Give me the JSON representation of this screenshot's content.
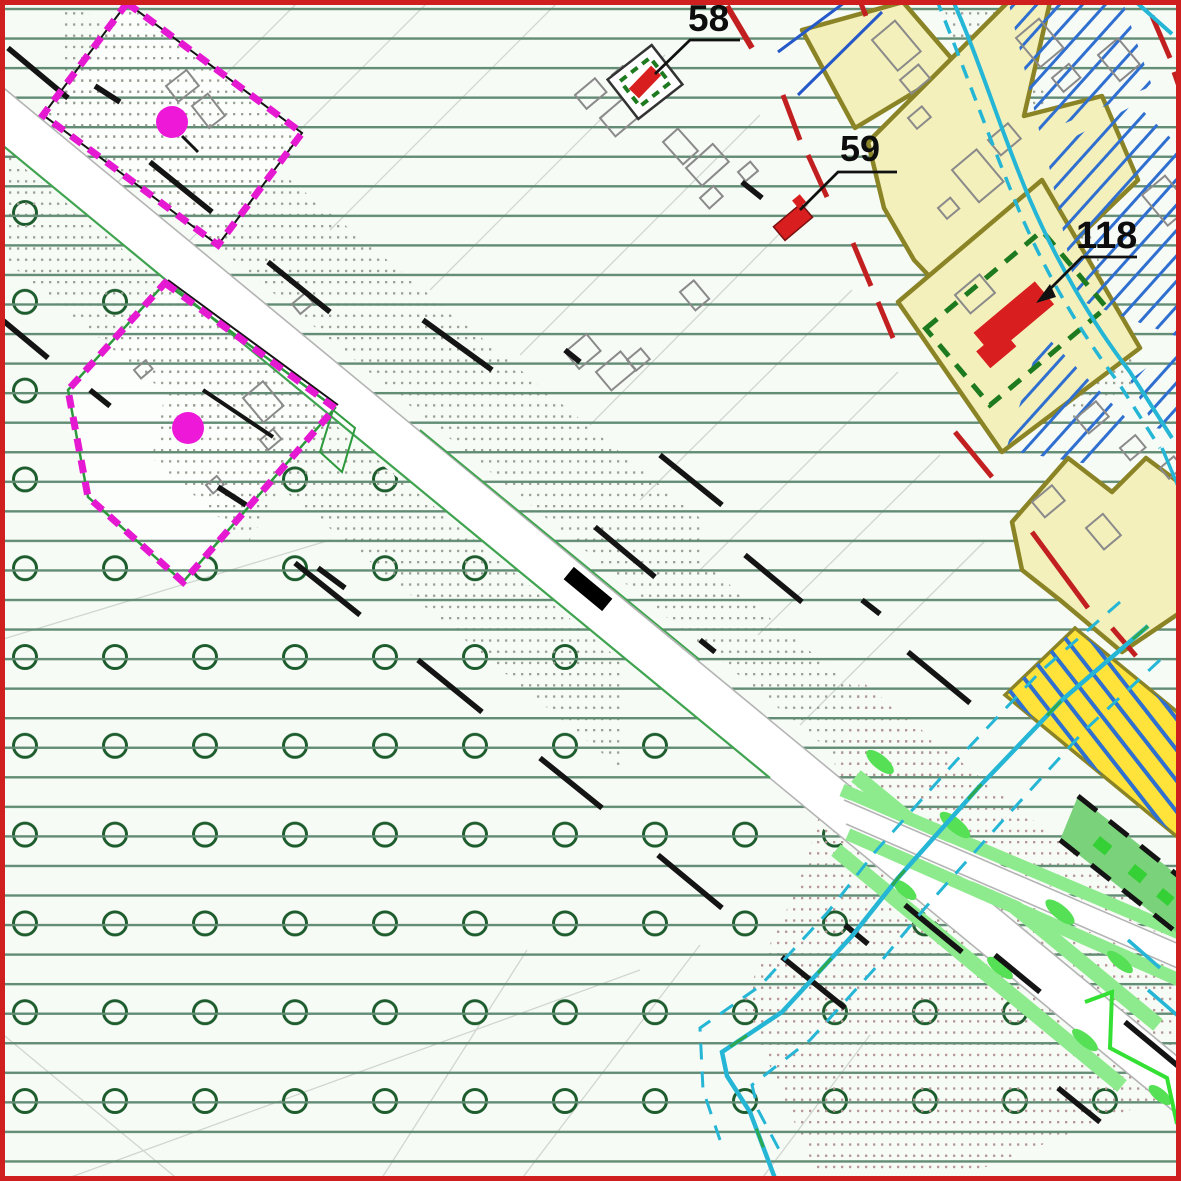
{
  "map": {
    "kind": "cadastral-zoning-plan",
    "labels": [
      {
        "id": "parcel-58",
        "text": "58"
      },
      {
        "id": "parcel-59",
        "text": "59"
      },
      {
        "id": "parcel-118",
        "text": "118"
      }
    ],
    "colors": {
      "frame_red": "#d01f1f",
      "background": "#f7fbf6",
      "grid_line_green": "#628c74",
      "orchard_circle_green": "#1d5c2d",
      "boundary_magenta": "#e619d2",
      "boundary_outline_black": "#141414",
      "boundary_outline_green": "#2c9a3c",
      "zone_fill_pale_yellow": "#f4f0bc",
      "zone_border_olive": "#8b8426",
      "bright_zone_yellow": "#ffe23a",
      "hatch_blue": "#2f6fd0",
      "water_cyan": "#25b6d6",
      "water_green": "#2ea84e",
      "building_red": "#d81e1e",
      "building_gray_outline": "#8a8a8a",
      "road_fill": "#ffffff",
      "road_edge_gray": "#b4b4b4",
      "road_edge_green": "#3fa34f",
      "verge_light_green": "#8deb8d",
      "verge_blob_green": "#55e055",
      "strip_green": "#7ad37a",
      "black_dash": "#141414",
      "red_boundary_dash": "#c22020",
      "stipple_gray": "#9aa094",
      "stipple_rose": "#b39595",
      "protected_green_dash": "#1e7a1e",
      "parcel_line_gray": "#d0d6d0",
      "magenta_dot": "#ee18d8"
    },
    "symbols": [
      "orchard-circle-icon",
      "magenta-boundary-dash-icon",
      "red-building-icon",
      "green-dash-protection-icon",
      "water-line-icon",
      "tree-blob-icon",
      "stipple-dot-icon",
      "black-long-dash-icon"
    ]
  }
}
